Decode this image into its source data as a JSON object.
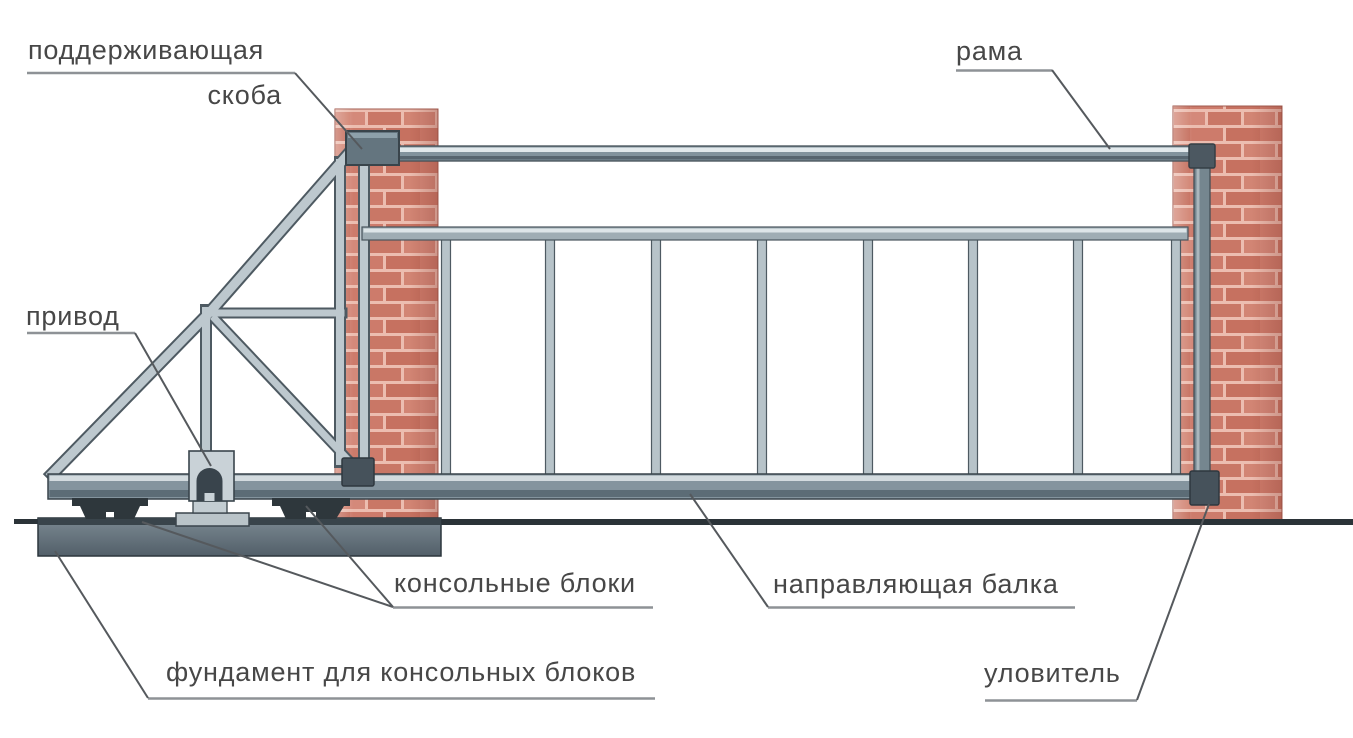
{
  "diagram": {
    "kind": "labeled-technical-diagram",
    "language": "ru"
  },
  "labels": {
    "supporting_bracket": {
      "line1": "поддерживающая",
      "line2": "скоба"
    },
    "frame": "рама",
    "drive": "привод",
    "cantilever_blocks": "консольные блоки",
    "guide_beam": "направляющая балка",
    "foundation": "фундамент для консольных блоков",
    "catcher": "уловитель"
  },
  "colors": {
    "background": "#ffffff",
    "brick": "#cd7b6b",
    "brick_alt": "#c67160",
    "brick_mortar": "#ecbdb0",
    "metal_light": "#bdc8ce",
    "metal_mid": "#84949e",
    "metal_outline": "#4e5a62",
    "hardware_dark": "#46525b",
    "foundation": "#6b7a84",
    "ground": "#2b3338",
    "label_text": "#474747",
    "leader_line": "#55595d",
    "underline": "#8e9296"
  }
}
